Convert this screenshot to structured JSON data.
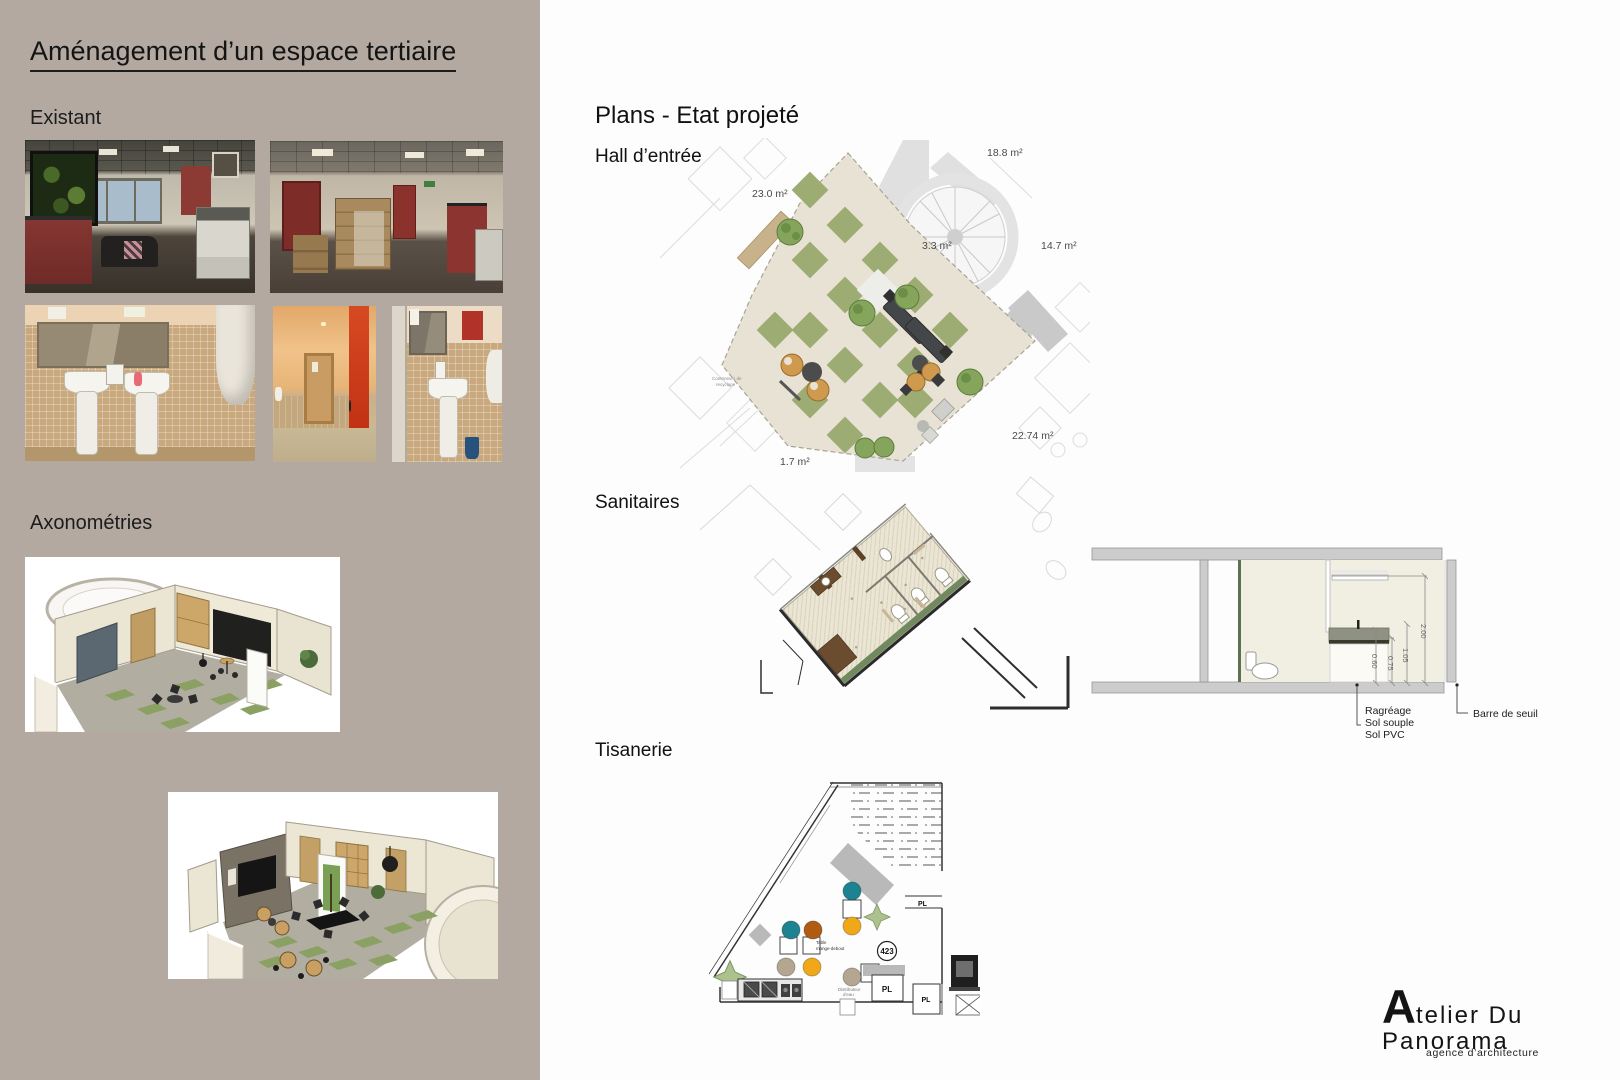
{
  "board": {
    "title": "Aménagement d’un espace tertiaire"
  },
  "left_panel": {
    "existant_label": "Existant",
    "axonometries_label": "Axonométries"
  },
  "plans": {
    "heading": "Plans - Etat projeté",
    "hall": {
      "label": "Hall d’entrée",
      "areas": {
        "a23": "23.0 m²",
        "a188": "18.8 m²",
        "a33": "3.3 m²",
        "a147": "14.7 m²",
        "a2274": "22.74 m²",
        "a17": "1.7 m²"
      },
      "recycling_note_line1": "Conteneurs de",
      "recycling_note_line2": "recyclage"
    },
    "sanitaires": {
      "label": "Sanitaires"
    },
    "section": {
      "dims": {
        "d060": "0.60",
        "d075": "0.75",
        "d105": "1.05",
        "d200": "2.00"
      },
      "callout_floor_1": "Ragréage",
      "callout_floor_2": "Sol souple",
      "callout_floor_3": "Sol PVC",
      "callout_threshold": "Barre de seuil"
    },
    "tisanerie": {
      "label": "Tisanerie",
      "room_number": "423",
      "pl_label": "PL",
      "table_label_line1": "Table",
      "table_label_line2": "mange-debout",
      "water_label_line1": "Distributeur",
      "water_label_line2": "d’eau"
    }
  },
  "footer_logo": {
    "name": "Atelier Du Panorama",
    "subtitle": "agence d’architecture"
  },
  "colors": {
    "panel_bg": "#b3a9a1",
    "plan_floor_beige": "#e7e2d4",
    "plan_green": "#9dac72",
    "sanitaires_green_strip": "#70895f",
    "stool_teal": "#1d8391",
    "stool_rust": "#b05a14",
    "stool_yellow": "#f0a818",
    "stool_taupe": "#b5a692"
  }
}
